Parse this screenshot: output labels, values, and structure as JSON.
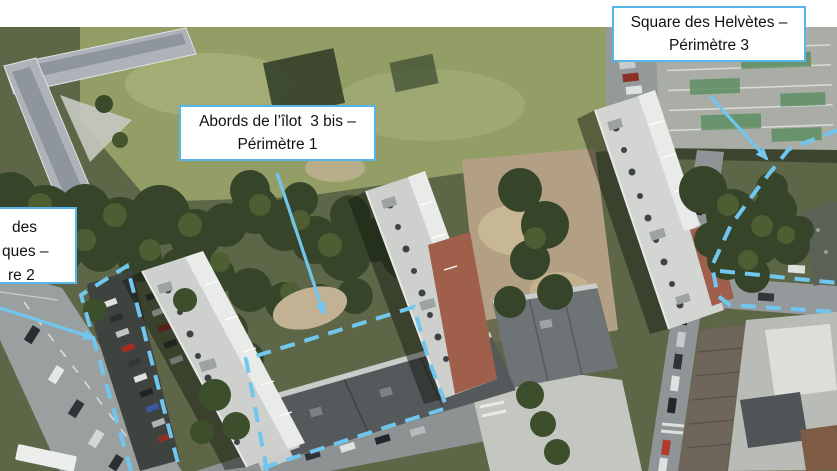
{
  "colors": {
    "annotation": "#70C6EE",
    "label_border": "#56B6E8",
    "label_bg": "#FFFFFF",
    "label_text": "#111111"
  },
  "labels": {
    "perimetre1": {
      "line1": "Abords de l’îlot  3 bis –",
      "line2": "Périmètre 1"
    },
    "perimetre2": {
      "line1": "des",
      "line2": "ques –",
      "line3": "re 2"
    },
    "perimetre3": {
      "line1": "Square des Helvètes –",
      "line2": "Périmètre 3"
    }
  }
}
